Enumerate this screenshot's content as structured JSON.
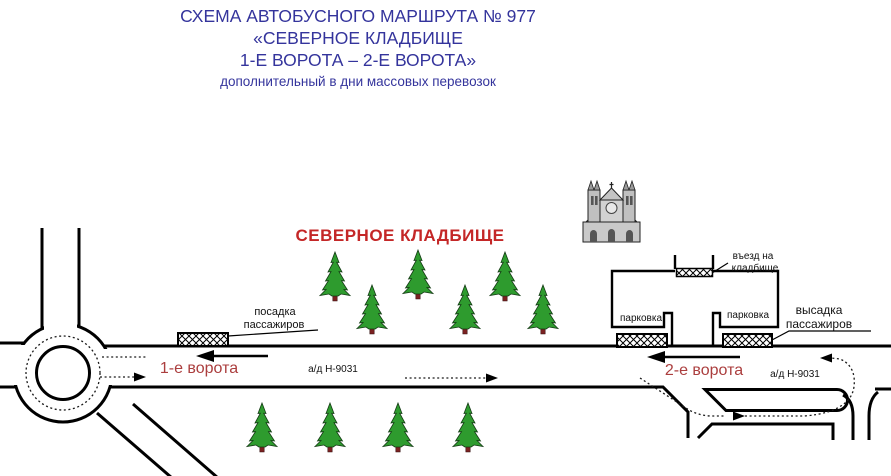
{
  "header": {
    "line1": "СХЕМА АВТОБУСНОГО МАРШРУТА № 977",
    "line2": "«СЕВЕРНОЕ КЛАДБИЩЕ",
    "line3": "1-Е ВОРОТА – 2-Е ВОРОТА»",
    "subtitle": "дополнительный в дни массовых перевозок"
  },
  "diagram": {
    "cemetery_title": "СЕВЕРНОЕ КЛАДБИЩЕ",
    "gate1": "1-е ворота",
    "gate2": "2-е ворота",
    "road_name_left": "а/д Н-9031",
    "road_name_right": "а/д Н-9031",
    "boarding_line1": "посадка",
    "boarding_line2": "пассажиров",
    "alighting_line1": "высадка",
    "alighting_line2": "пассажиров",
    "entrance_line1": "въезд на",
    "entrance_line2": "кладбище",
    "parking_left": "парковка",
    "parking_right": "парковка"
  },
  "colors": {
    "title_blue": "#34349c",
    "cemetery_red": "#c42727",
    "gate_red": "#ab3e3e",
    "tree_green": "#2e9b2e",
    "trunk_brown": "#7b2121",
    "road_black": "#000000"
  }
}
